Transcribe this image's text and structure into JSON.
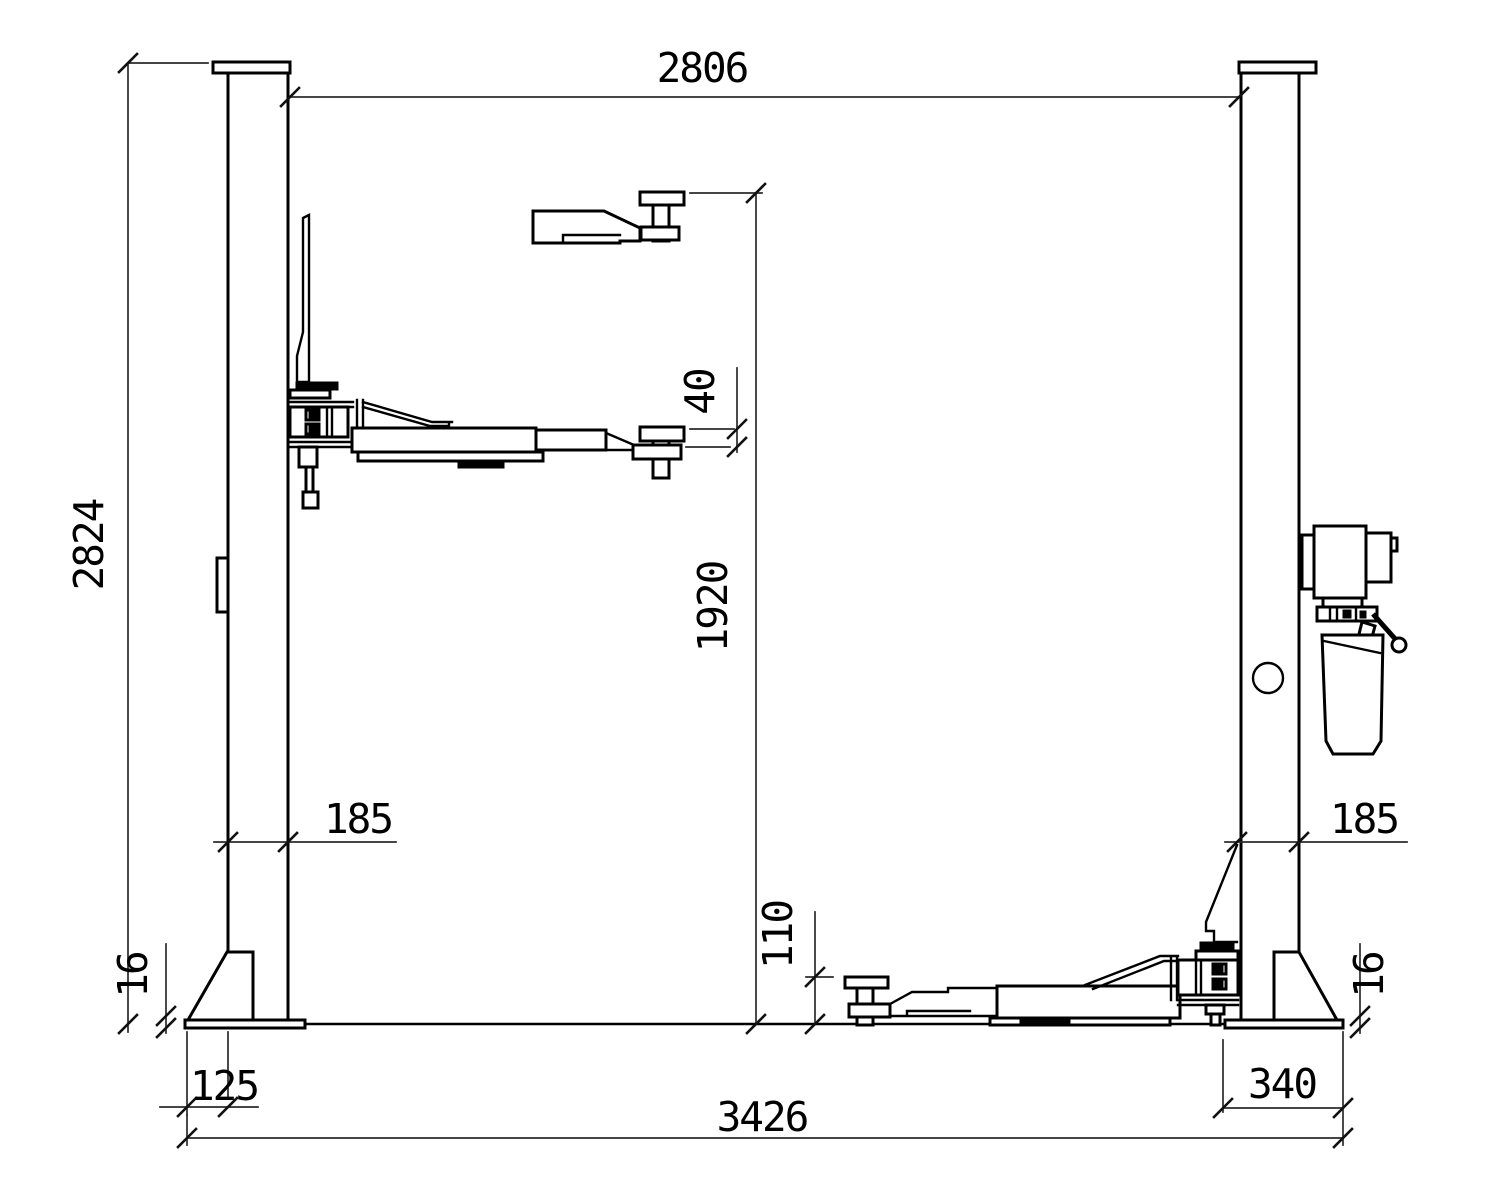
{
  "meta": {
    "drawing_type": "two-post car lift side elevation",
    "units": "mm"
  },
  "dimensions": {
    "span_between_columns": "2806",
    "total_height": "2824",
    "max_lift_height": "1920",
    "pad_screw_travel": "40",
    "column_width_left": "185",
    "column_width_right": "185",
    "pad_min_height": "110",
    "base_plate_thickness_left": "16",
    "base_plate_thickness_right": "16",
    "base_plate_offset_left": "125",
    "base_plate_width_right": "340",
    "overall_length": "3426"
  }
}
